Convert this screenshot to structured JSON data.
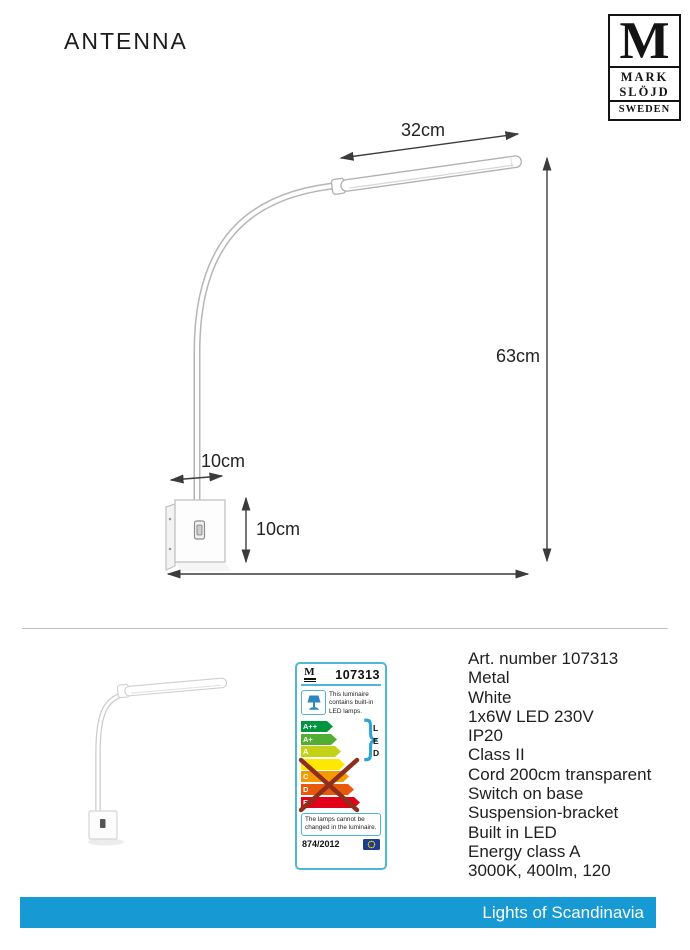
{
  "header": {
    "title": "ANTENNA",
    "logo": {
      "m": "M",
      "word1": "MARK",
      "word2": "SLÖJD",
      "word3": "SWEDEN"
    }
  },
  "diagram": {
    "dimensions": {
      "head_length": "32cm",
      "height": "63cm",
      "bracket_width": "10cm",
      "bracket_height": "10cm"
    }
  },
  "energy_label": {
    "border_color": "#4fb6d9",
    "logo_letter": "M",
    "article_number": "107313",
    "luminaire_note": "This luminaire contains built-in LED lamps.",
    "led_letters": [
      "L",
      "E",
      "D"
    ],
    "classes": [
      {
        "label": "A++",
        "color": "#009640",
        "width": 26
      },
      {
        "label": "A+",
        "color": "#52ae32",
        "width": 30
      },
      {
        "label": "A",
        "color": "#c3d117",
        "width": 34
      },
      {
        "label": "B",
        "color": "#ffe800",
        "width": 38
      },
      {
        "label": "C",
        "color": "#f59b00",
        "width": 42
      },
      {
        "label": "D",
        "color": "#e8590c",
        "width": 47
      },
      {
        "label": "E",
        "color": "#e2001a",
        "width": 53
      }
    ],
    "crossed_out": true,
    "cross_color": "#8e2f1d",
    "lamps_note": "The lamps cannot be changed in the luminaire.",
    "regulation": "874/2012"
  },
  "specs": {
    "lines": [
      "Art. number 107313",
      "Metal",
      "White",
      "1x6W LED 230V",
      "IP20",
      "Class II",
      "Cord 200cm transparent",
      "Switch on base",
      "Suspension-bracket",
      "Built in LED",
      "Energy class A",
      "3000K, 400lm, 120"
    ]
  },
  "footer": {
    "brand": "Lights of Scandinavia",
    "bar_color": "#1799d4"
  }
}
